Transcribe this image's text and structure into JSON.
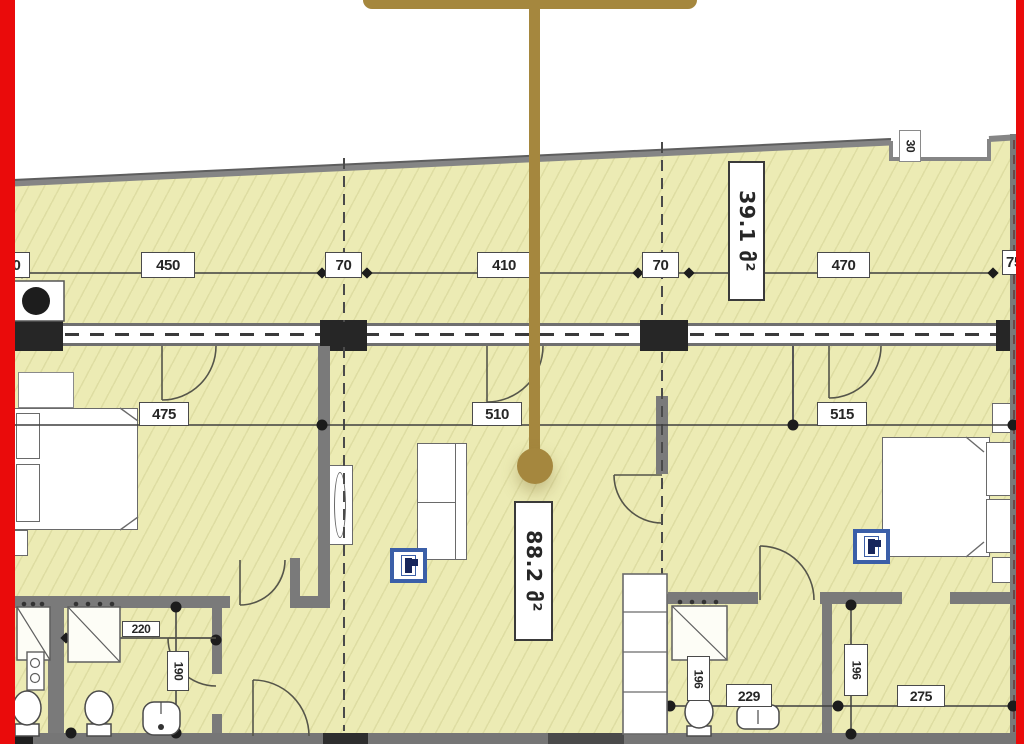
{
  "colors": {
    "edge_red": "#ea0b0b",
    "callout_gold": "#a5873e",
    "floor_fill": "#ecebb4",
    "wall_gray": "#7a7a7a",
    "column_black": "#262626",
    "icon_blue": "#3b5fa8"
  },
  "areas": {
    "room_top": "39.1 მ²",
    "room_main": "88.2 მ²"
  },
  "dims": {
    "top_left_cut": "0",
    "top_450": "450",
    "top_70a": "70",
    "top_410": "410",
    "top_70b": "70",
    "top_470": "470",
    "top_right_cut": "75",
    "mid_475": "475",
    "mid_510": "510",
    "mid_515": "515",
    "bath_220": "220",
    "bath_190": "190",
    "bath2_196": "196",
    "bath2_229": "229",
    "bed_196": "196",
    "bed_275": "275",
    "notch_30": "30"
  },
  "icons": {
    "location_marker": "location-pin-callout",
    "wall_unit_a": "wall-panel-icon",
    "wall_unit_b": "wall-panel-icon"
  }
}
